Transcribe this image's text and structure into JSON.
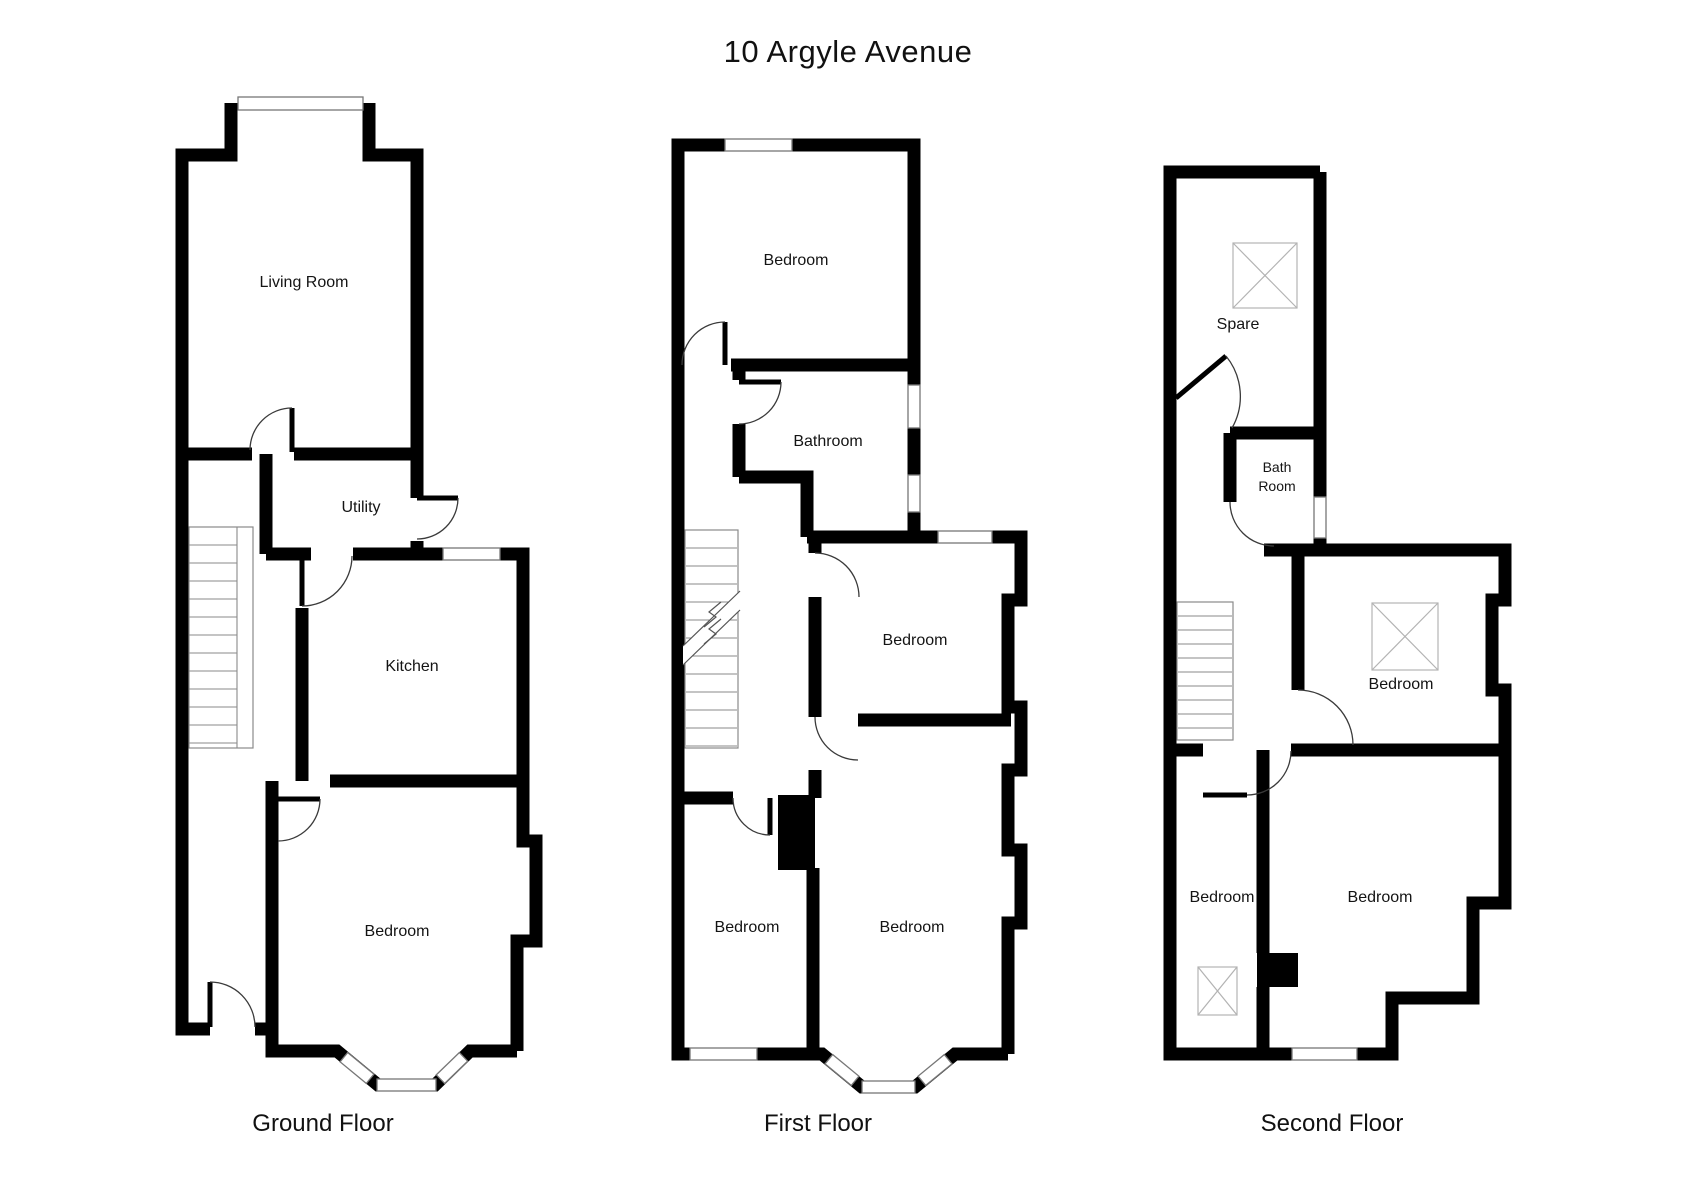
{
  "title": "10 Argyle Avenue",
  "floors": [
    {
      "label": "Ground Floor",
      "rooms": {
        "living_room": "Living Room",
        "utility": "Utility",
        "kitchen": "Kitchen",
        "bedroom": "Bedroom"
      }
    },
    {
      "label": "First Floor",
      "rooms": {
        "bedroom_front": "Bedroom",
        "bathroom": "Bathroom",
        "bedroom_middle": "Bedroom",
        "bedroom_back_left": "Bedroom",
        "bedroom_back_right": "Bedroom"
      }
    },
    {
      "label": "Second Floor",
      "rooms": {
        "spare": "Spare",
        "bath_line1": "Bath",
        "bath_line2": "Room",
        "bedroom_middle": "Bedroom",
        "bedroom_back_left": "Bedroom",
        "bedroom_back_right": "Bedroom"
      }
    }
  ],
  "colors": {
    "wall": "#000000",
    "background": "#ffffff",
    "text": "#141414",
    "stairs": "#8a8a8a",
    "window_frame": "#777777",
    "rooflight": "#b3b3b3",
    "door_arc": "#3a3a3a"
  }
}
